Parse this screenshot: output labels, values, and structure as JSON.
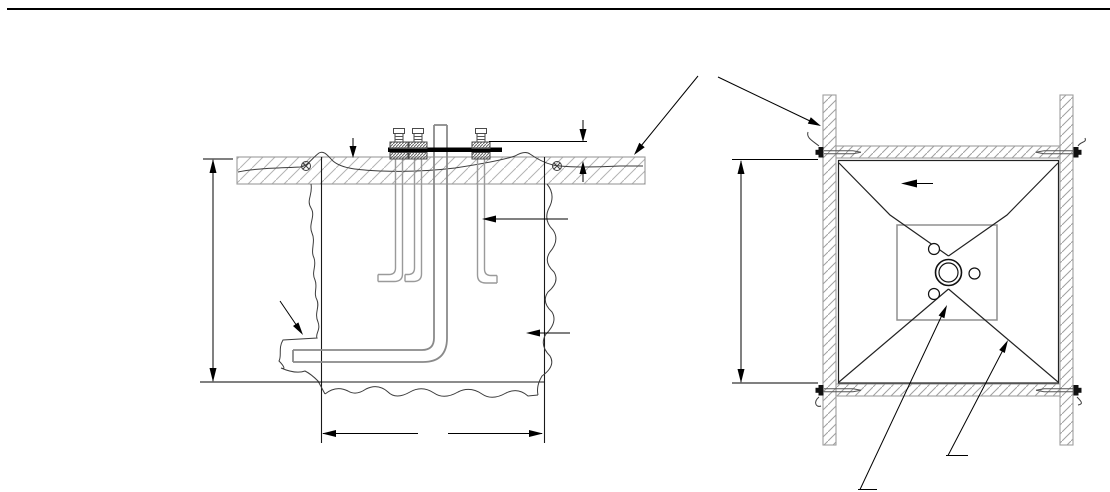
{
  "figure": {
    "title": "",
    "type": "technical-drawing",
    "text_labels": [],
    "views": [
      {
        "id": "section-view",
        "elements": [
          "concrete-slab-hatched",
          "slab-reinforcement-wavy-line",
          "rebar-section-symbol-left",
          "rebar-section-symbol-right",
          "pier-outline",
          "earth-break-lines",
          "anchor-j-bolt-left-1",
          "anchor-j-bolt-left-2",
          "anchor-j-bolt-right",
          "template-plate",
          "leveling-nuts",
          "conduit-elbow",
          "overall-depth-dimension",
          "pier-width-dimension",
          "projection-mini-dimension",
          "grade-down-arrow",
          "bolt-offset-arrow",
          "pier-pointer-arrow",
          "conduit-leader-arrow"
        ]
      },
      {
        "id": "plan-view",
        "elements": [
          "form-board-left",
          "form-board-right",
          "form-board-top",
          "form-board-bottom",
          "corner-screws-with-string-curls",
          "inner-concrete-outline",
          "diagonal-string-lines",
          "template-plate-square",
          "conduit-double-circle",
          "bolt-hole-circles",
          "height-dimension",
          "direction-arrow",
          "template-leader-arrow",
          "string-leader-arrow"
        ]
      }
    ],
    "callouts": {
      "forms-callout-two-arms": true,
      "dimension_texts_visible": false
    }
  },
  "colors": {
    "bg": "#ffffff",
    "line": "#1a1a1a",
    "dim": "#000000",
    "gray": "#8f8f8f",
    "pipe": "#8a8a8a",
    "bolt": "#9a9a9a",
    "slabedge": "#9a9a9a",
    "hatch": "#b3b3b3",
    "boardhatch": "#9f9f9f",
    "earth": "#3c3c3c",
    "plate": "#000000",
    "nut": "#4a4a4a",
    "screw": "#111111"
  },
  "canvas": {
    "width": 1110,
    "height": 492
  }
}
